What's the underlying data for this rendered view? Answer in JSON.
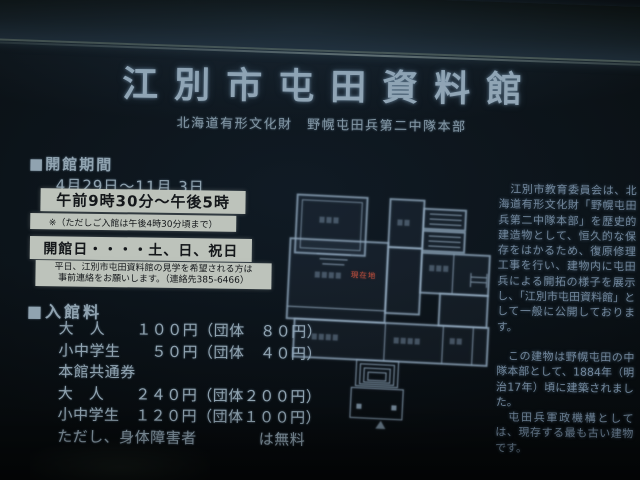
{
  "sign": {
    "title": "江別市屯田資料館",
    "subtitle": "北海道有形文化財　野幌屯田兵第二中隊本部",
    "hours": {
      "heading": "■開館期間",
      "period": "4月29日～11月 3日",
      "time": "午前9時30分～午後5時",
      "time_note": "※（ただしご入館は午後4時30分頃まで）",
      "open_days": "開館日・・・・土、日、祝日",
      "weekday_note_line1": "平日、江別市屯田資料館の見学を希望される方は",
      "weekday_note_line2": "事前連絡をお願いします。（連絡先385-6466）"
    },
    "fees": {
      "heading": "■入館料",
      "rows": [
        "大　人　　１００円（団体　８０円）",
        "小中学生　　５０円（団体　４０円）",
        "本館共通券",
        "大　人　　２４０円（団体２００円）",
        "小中学生　１２０円（団体１００円）",
        "ただし、身体障害者　　　　は無料"
      ]
    },
    "description": {
      "paragraph1": "　江別市教育委員会は、北海道有形文化財「野幌屯田兵第二中隊本部」を歴史的建造物として、恒久的な保存をはかるため、復原修理工事を行い、建物内に屯田兵による開拓の様子を展示し、「江別市屯田資料館」として一般に公開しております。",
      "paragraph2": "　この建物は野幌屯田の中隊本部として、1884年（明治17年）頃に建築されました。",
      "paragraph3": "　屯田兵軍政機構としては、現存する最も古い建物です。"
    },
    "floorplan": {
      "marker_label": "現在地"
    }
  },
  "colors": {
    "background": "#0a0f12",
    "title_text": "#93a7b6",
    "body_text": "#90a3b0",
    "paragraph_text": "#70859a",
    "white_box_bg": "#bdc3bb",
    "white_box_text": "#14171a",
    "floorplan_line": "#8fa6ba",
    "marker_red": "#b04a3c"
  }
}
